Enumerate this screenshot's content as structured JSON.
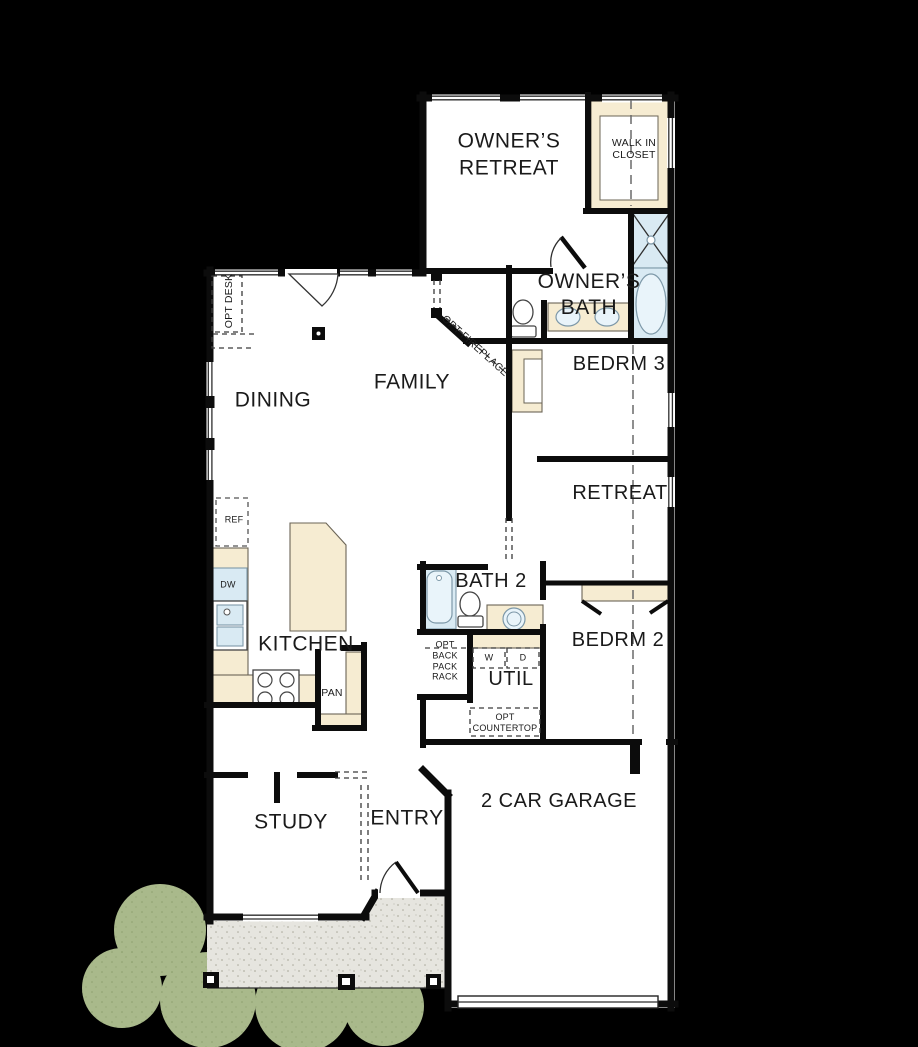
{
  "plan": {
    "rooms": {
      "owners_retreat": {
        "line1": "OWNER’S",
        "line2": "RETREAT"
      },
      "walk_in_closet": {
        "line1": "WALK IN",
        "line2": "CLOSET"
      },
      "owners_bath": {
        "line1": "OWNER’S",
        "line2": "BATH"
      },
      "bedrm3": "BEDRM 3",
      "retreat": "RETREAT",
      "family": "FAMILY",
      "dining": "DINING",
      "kitchen": "KITCHEN",
      "bath2": "BATH 2",
      "bedrm2": "BEDRM 2",
      "util": "UTIL",
      "study": "STUDY",
      "entry": "ENTRY",
      "garage": "2 CAR GARAGE"
    },
    "annotations": {
      "opt_desk": "OPT DESK",
      "opt_fireplace": "OPT FIREPLACE",
      "fridge": "REF",
      "dishwasher": "DW",
      "pantry": "PAN",
      "backpack_rack": {
        "line1": "OPT",
        "line2": "BACK",
        "line3": "PACK",
        "line4": "RACK"
      },
      "washer": "W",
      "dryer": "D",
      "opt_countertop": {
        "line1": "OPT",
        "line2": "COUNTERTOP"
      }
    },
    "colors": {
      "background": "#000000",
      "floor": "#ffffff",
      "wall": "#0c0c0c",
      "ink": "#1a1a1a",
      "cabinet": "#f6ecd2",
      "cabinet_line": "#6b6456",
      "fixture": "#d9eaf3",
      "fixture_line": "#7d98a8",
      "porch": "#e6e5df",
      "shrub": "#a9b98b"
    }
  }
}
